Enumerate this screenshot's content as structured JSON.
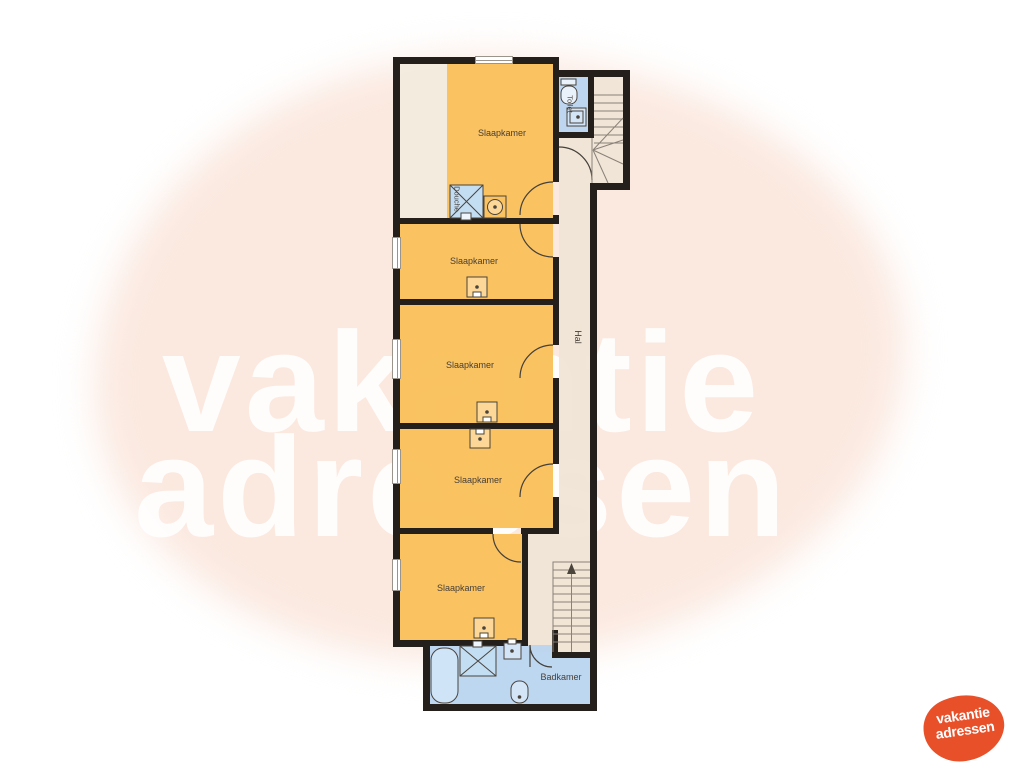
{
  "watermark": {
    "line1": "vakantie",
    "line2": "adressen"
  },
  "logo": {
    "line1": "vakantie",
    "line2": "adressen"
  },
  "rooms": {
    "bedroom1": {
      "label": "Slaapkamer"
    },
    "bedroom2": {
      "label": "Slaapkamer"
    },
    "bedroom3": {
      "label": "Slaapkamer"
    },
    "bedroom4": {
      "label": "Slaapkamer"
    },
    "bedroom5": {
      "label": "Slaapkamer"
    },
    "hall": {
      "label": "Hal"
    },
    "toilet": {
      "label": "Toilet"
    },
    "shower": {
      "label": "Douche"
    },
    "bathroom": {
      "label": "Badkamer"
    }
  },
  "colors": {
    "room_orange": "#fac363",
    "corridor_cream": "#f1e6d8",
    "wet_room_blue": "#bed9f1",
    "wall": "#241f1b",
    "watermark_blob": "#fbe9e0",
    "logo_orange": "#e8502a"
  }
}
